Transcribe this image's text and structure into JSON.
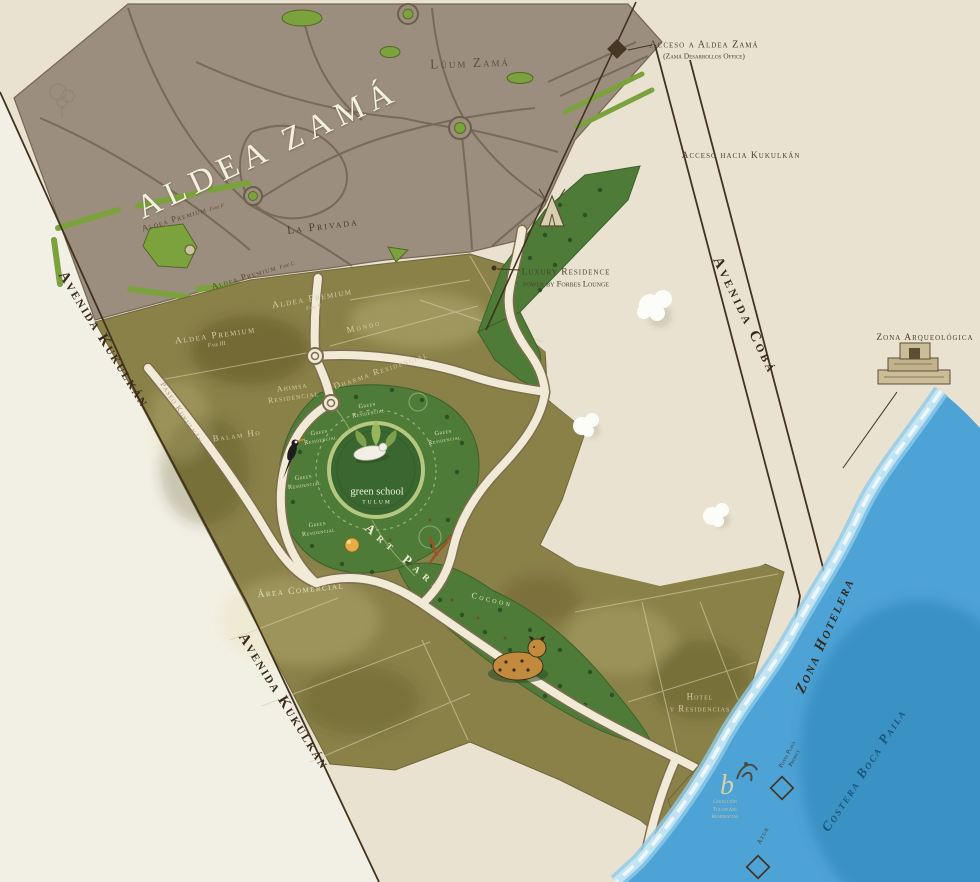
{
  "title": "Aldea Zamá",
  "roads": {
    "avenida_kukulkan": "Avenida Kukulkán",
    "paseo_kukulkan": "Paseo Kukulkán",
    "avenida_coba": "Avenida Cobá",
    "acceso_hacia_kukulkan": "Acceso hacia Kukulkán",
    "zona_hotelera": "Zona Hotelera",
    "costera_boca_paila": "Costera Boca Paila"
  },
  "markers": {
    "acceso_aldea": {
      "label": "Acceso a Aldea Zamá",
      "sublabel": "(Zamá Desarrollos Office)"
    },
    "luxury": {
      "line1": "Luxury Residence",
      "line2": "power by Forbes Lounge"
    },
    "zona_arqueologica": "Zona Arqueológica",
    "punta_playa": {
      "line1": "Punta Playa",
      "line2": "Project"
    },
    "azur": "Azur",
    "beach_logo": {
      "glyph": "b",
      "line1": "Colección",
      "line2": "Tulum Art",
      "line3": "Residencias"
    }
  },
  "zones": {
    "luum_zama": "Lúum Zamá",
    "la_privada": "La Privada",
    "premium1": {
      "name": "Aldea Premium",
      "phase": "Fase F"
    },
    "premium2": {
      "name": "Aldea Premium",
      "phase": "Fase C"
    },
    "premium3": {
      "name": "Aldea Premium",
      "phase": "Fase III"
    },
    "premium5": {
      "name": "Aldea Premium",
      "phase": "Fase V"
    },
    "mondo": "Mondo",
    "dharma": "Dharma Residencial",
    "ahimsa": {
      "line1": "Ahimsa",
      "line2": "Residencial"
    },
    "balam_ho": "Balam Ho",
    "green_residencial": {
      "line1": "Green",
      "line2": "Residencial"
    },
    "green_school": {
      "line1": "green school",
      "line2": "TULUM"
    },
    "art_park": "Art Park",
    "cocoon": "Cocoon",
    "area_comercial": "Área Comercial",
    "hotel": {
      "line1": "Hotel",
      "line2": "y Residencias"
    }
  },
  "colors": {
    "paper": "#e9e2d0",
    "taupe": "#9c8e7f",
    "olive": "#8a8149",
    "jungle_green": "#4e7b37",
    "park_green": "#7ba23c",
    "road_cream": "#f1ead6",
    "ocean_blue": "#4da2d6",
    "label_brown": "#4e3f2a",
    "label_cream": "#d3c9a5"
  }
}
